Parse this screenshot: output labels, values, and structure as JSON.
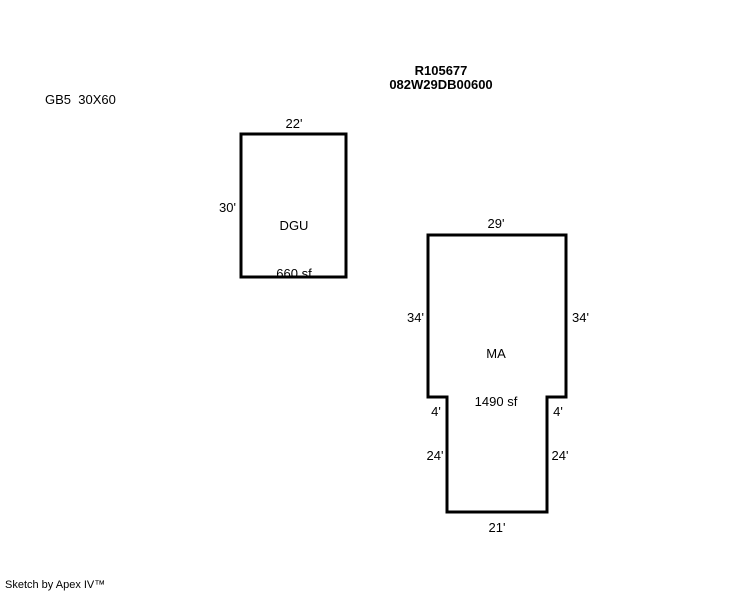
{
  "colors": {
    "background": "#ffffff",
    "line": "#000000",
    "text": "#000000"
  },
  "header": {
    "parcel_number": "R105677",
    "account_number": "082W29DB00600"
  },
  "note": "GB5  30X60",
  "buildings": {
    "dgu": {
      "name": "DGU",
      "area": "660 sf",
      "dim_top": "22'",
      "dim_left": "30'"
    },
    "ma": {
      "name": "MA",
      "area": "1490 sf",
      "dim_top": "29'",
      "dim_left_upper": "34'",
      "dim_right_upper": "34'",
      "dim_left_step": "4'",
      "dim_right_step": "4'",
      "dim_left_lower": "24'",
      "dim_right_lower": "24'",
      "dim_bottom": "21'"
    }
  },
  "footer": "Sketch by Apex IV™"
}
